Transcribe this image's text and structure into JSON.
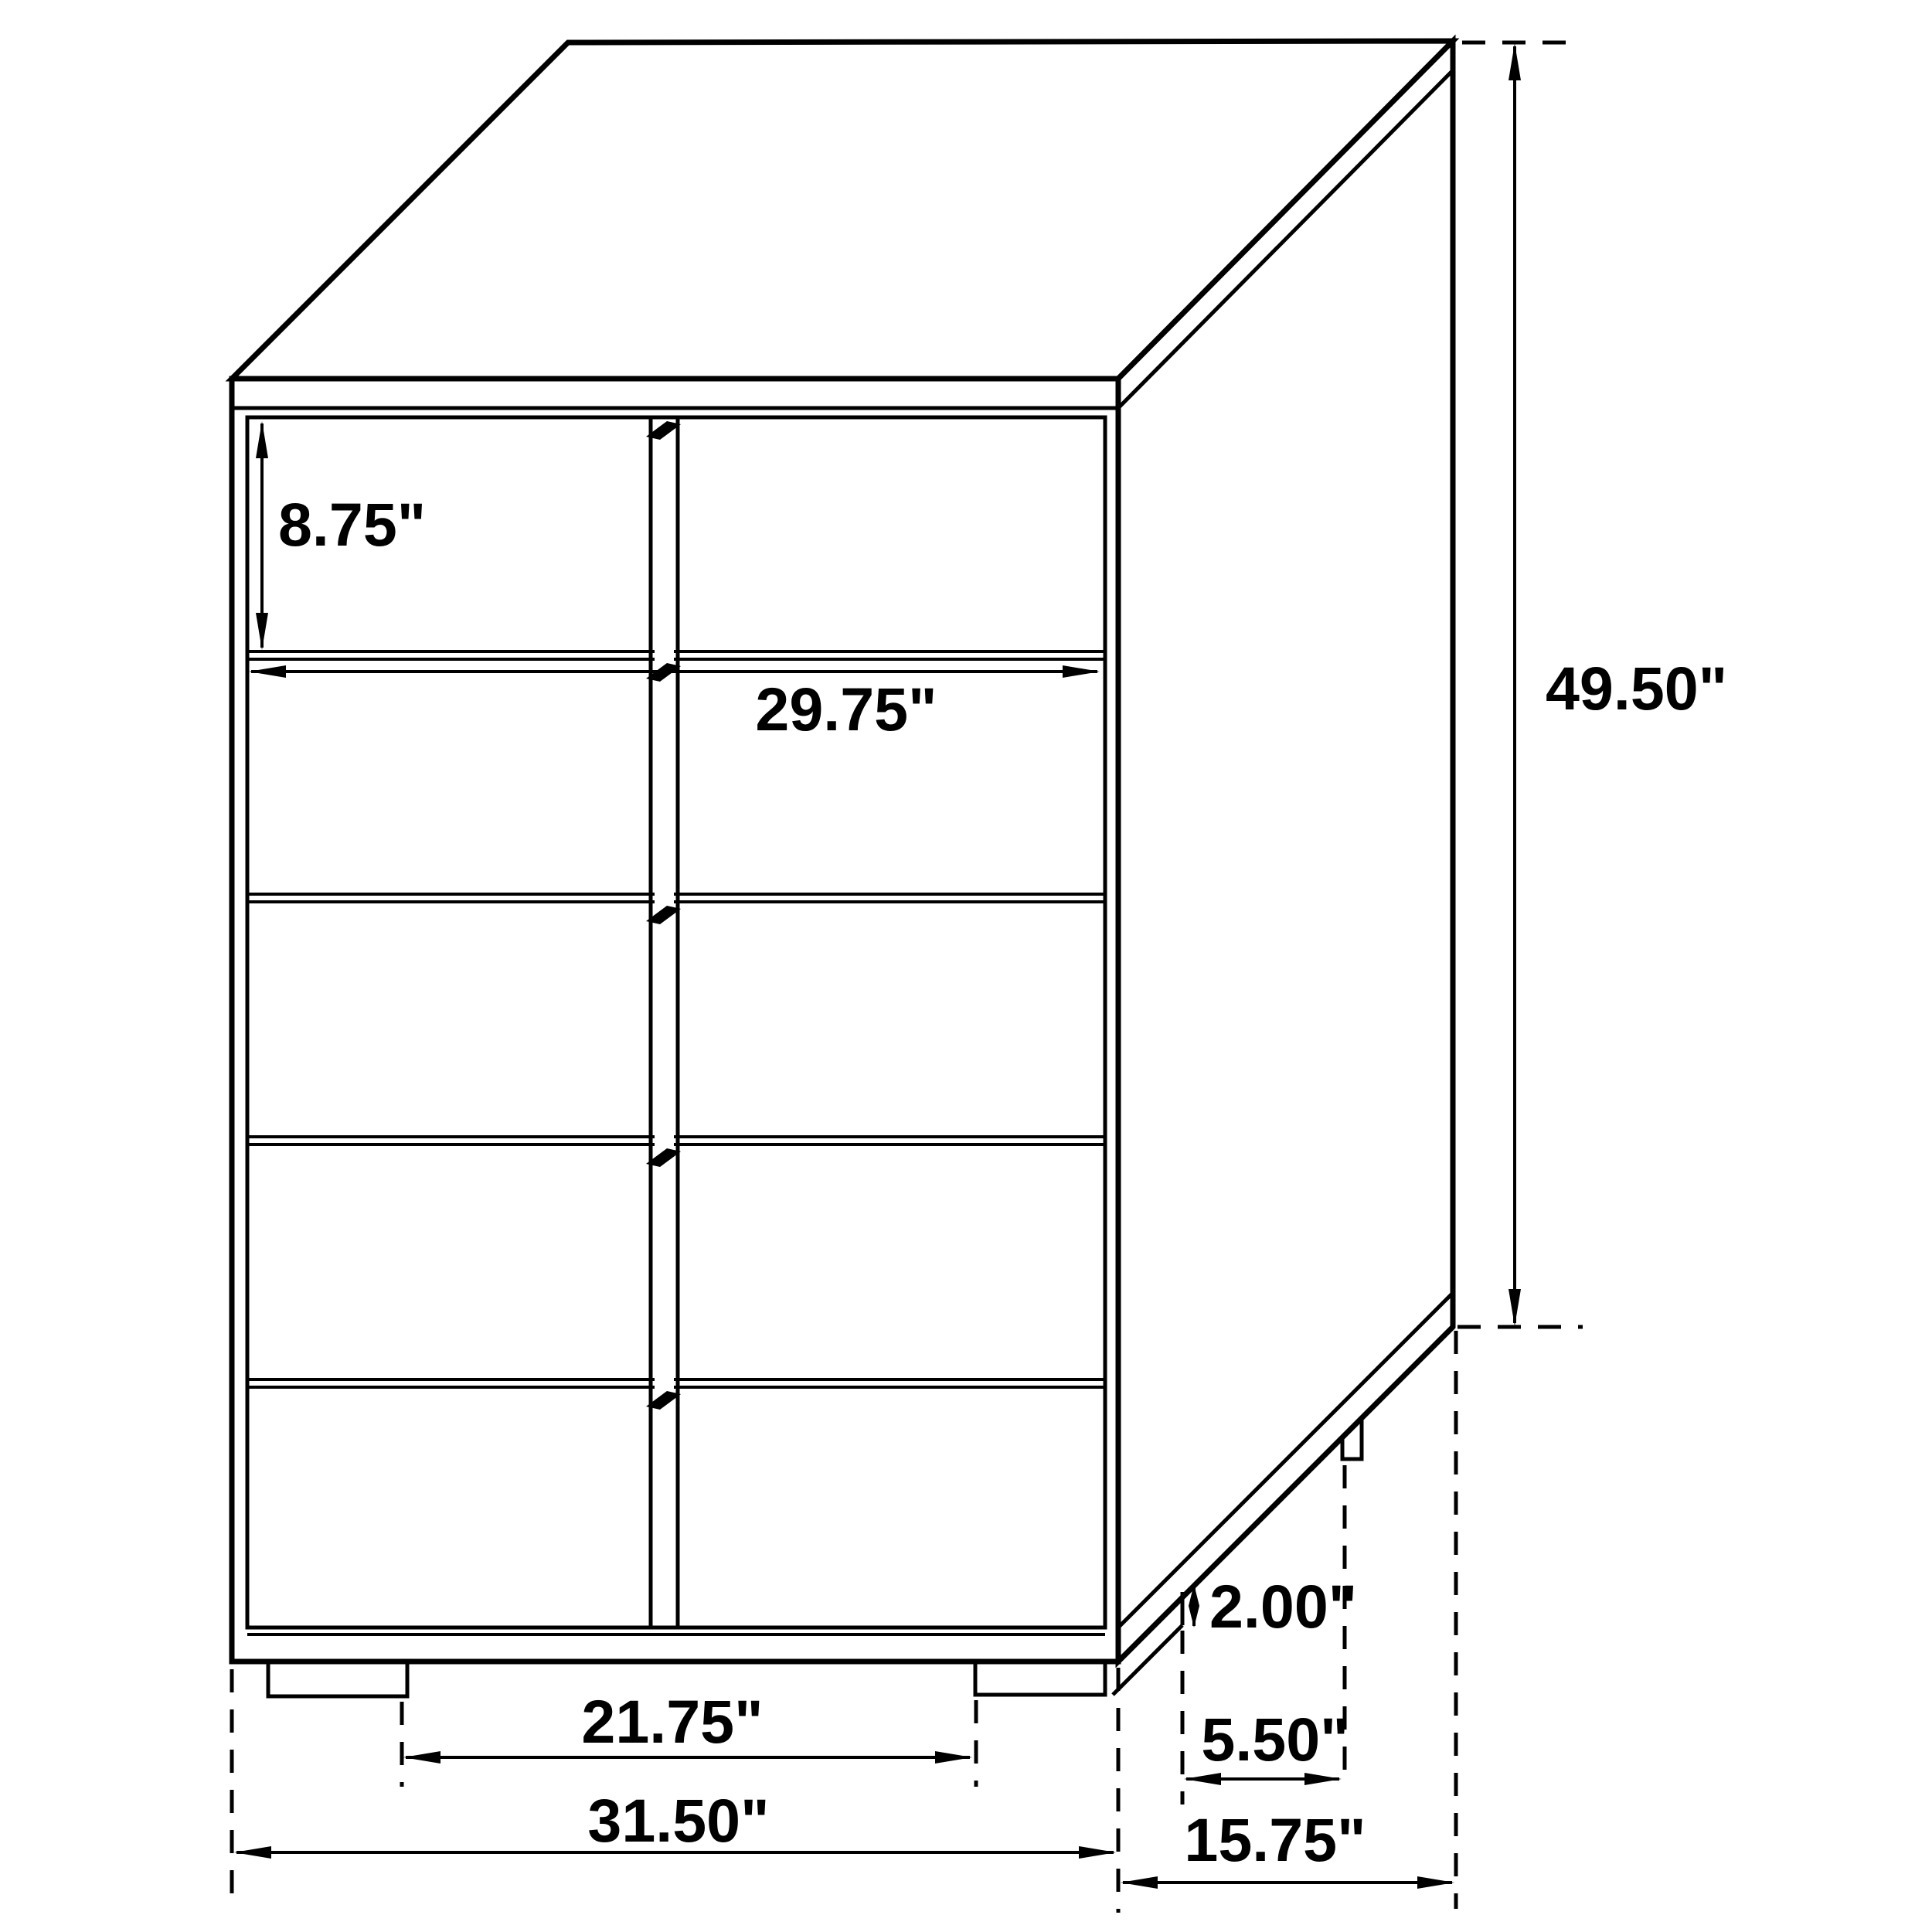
{
  "drawing": {
    "title": "chest-of-drawers-dimension-diagram",
    "unit": "inches",
    "line_color": "#000000",
    "background_color": "#ffffff",
    "labels": {
      "drawer_front_height": "8.75\"",
      "drawer_width": "29.75\"",
      "overall_height": "49.50\"",
      "leg_height": "2.00\"",
      "side_leg_spacing": "5.50\"",
      "front_leg_spacing": "21.75\"",
      "overall_width": "31.50\"",
      "overall_depth": "15.75\""
    }
  }
}
